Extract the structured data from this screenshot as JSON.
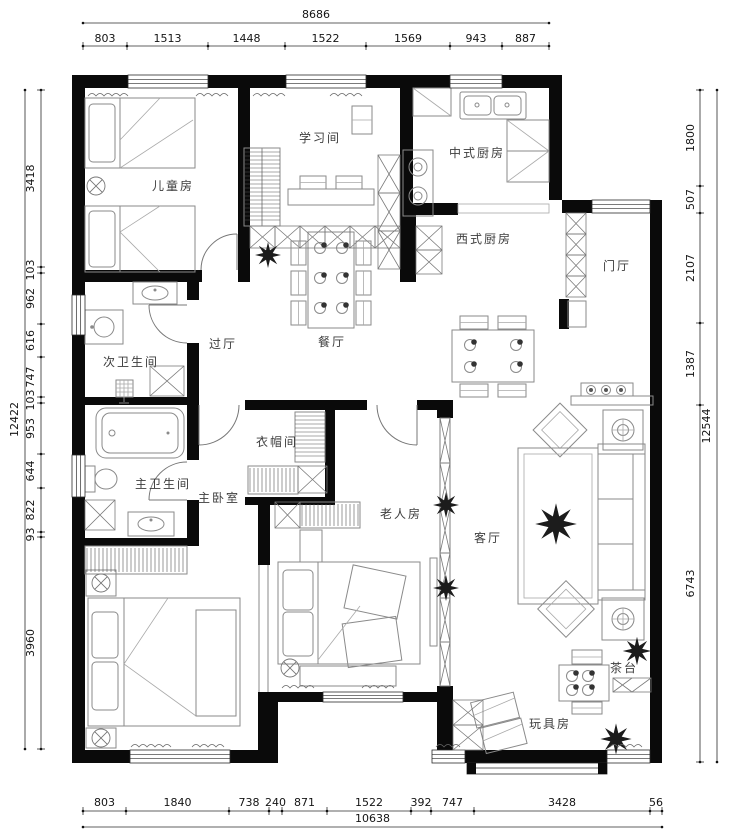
{
  "floor_plan": {
    "rooms": {
      "children_room": "儿童房",
      "study_room": "学习间",
      "chinese_kitchen": "中式厨房",
      "western_kitchen": "西式厨房",
      "entrance_hall": "门厅",
      "hallway": "过厅",
      "dining_room": "餐厅",
      "guest_bathroom": "次卫生间",
      "cloakroom": "衣帽间",
      "master_bathroom": "主卫生间",
      "master_bedroom": "主卧室",
      "elderly_room": "老人房",
      "living_room": "客厅",
      "tea_table": "茶台",
      "toy_room": "玩具房"
    },
    "dimensions": {
      "top": {
        "total": "8686",
        "segments": [
          "803",
          "1513",
          "1448",
          "1522",
          "1569",
          "943",
          "887"
        ]
      },
      "bottom": {
        "total": "10638",
        "segments": [
          "803",
          "1840",
          "738",
          "240",
          "871",
          "1522",
          "392",
          "747",
          "3428",
          "56"
        ]
      },
      "left": {
        "total": "12422",
        "segments": [
          "3418",
          "103",
          "962",
          "616",
          "747",
          "103",
          "953",
          "644",
          "822",
          "93",
          "3960"
        ]
      },
      "right": {
        "total": "12544",
        "segments": [
          "1800",
          "507",
          "2107",
          "1387",
          "6743"
        ]
      }
    }
  }
}
